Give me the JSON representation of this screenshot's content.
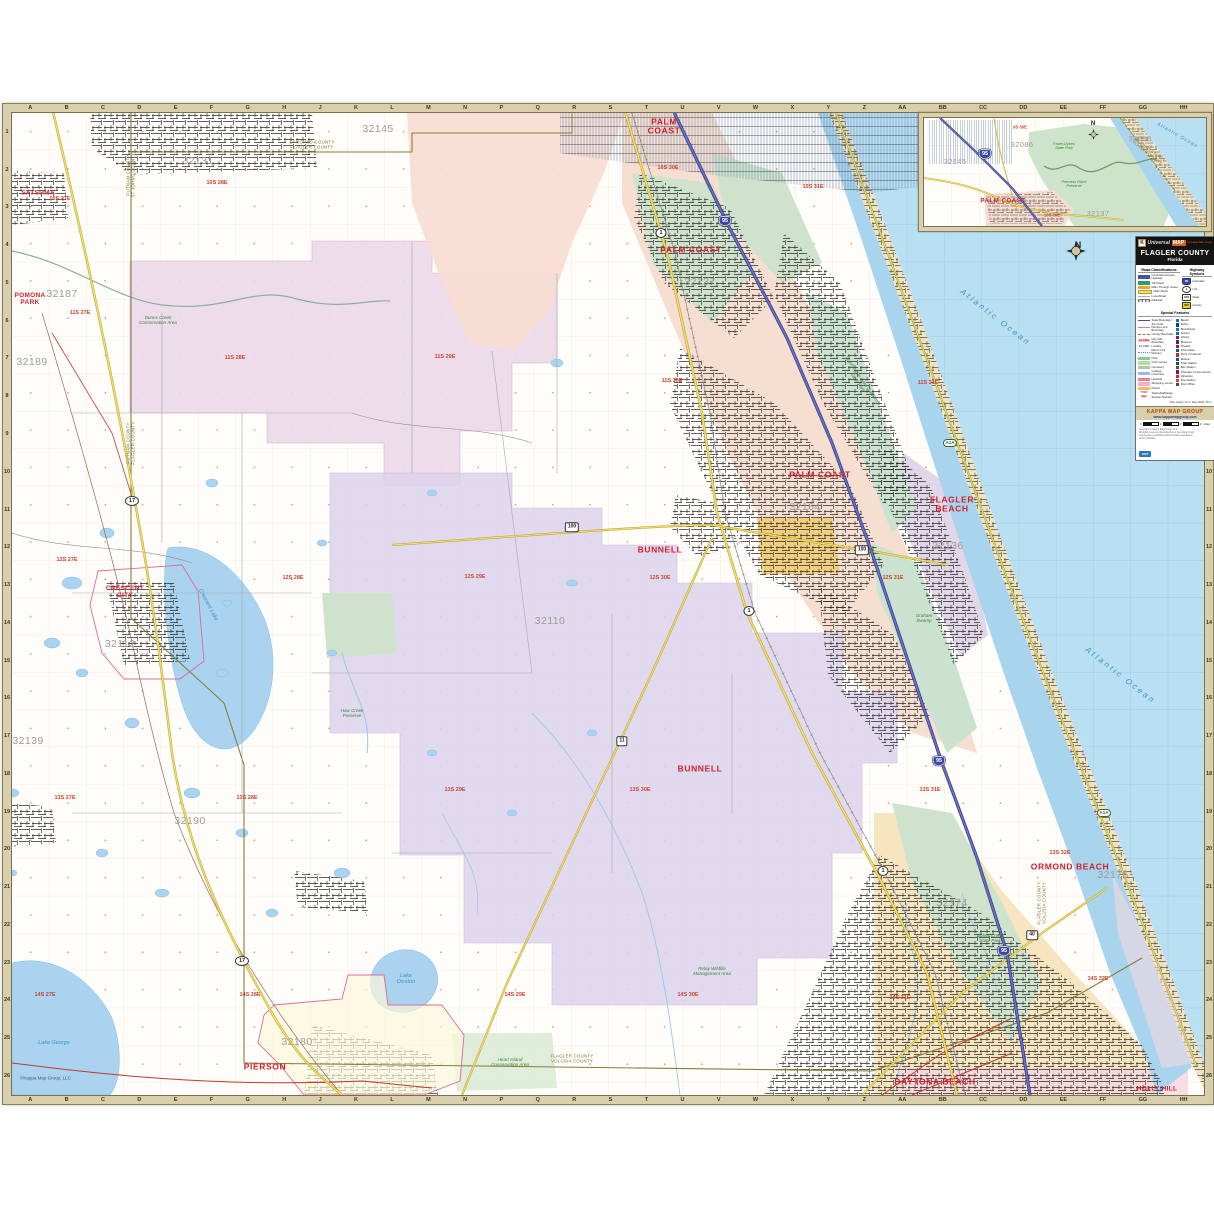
{
  "compass": {
    "n": "N"
  },
  "map": {
    "copyright": "©Kappa Map Group, LLC",
    "grid_letters": [
      "A",
      "B",
      "C",
      "D",
      "E",
      "F",
      "G",
      "H",
      "J",
      "K",
      "L",
      "M",
      "N",
      "P",
      "Q",
      "R",
      "S",
      "T",
      "U",
      "V",
      "W",
      "X",
      "Y",
      "Z",
      "AA",
      "BB",
      "CC",
      "DD",
      "EE",
      "FF",
      "GG",
      "HH"
    ],
    "grid_numbers": [
      "1",
      "2",
      "3",
      "4",
      "5",
      "6",
      "7",
      "8",
      "9",
      "10",
      "11",
      "12",
      "13",
      "14",
      "15",
      "16",
      "17",
      "18",
      "19",
      "20",
      "21",
      "22",
      "23",
      "24",
      "25",
      "26"
    ],
    "labels": [
      {
        "t": "PALM\nCOAST",
        "x": 652,
        "y": 14,
        "cls": "city",
        "n": "city-label-palm-coast-north"
      },
      {
        "t": "PALM COAST",
        "x": 679,
        "y": 137,
        "cls": "city",
        "n": "city-label-palm-coast"
      },
      {
        "t": "PALM COAST",
        "x": 808,
        "y": 362,
        "cls": "city",
        "n": "city-label-palm-coast-south"
      },
      {
        "t": "BUNNELL",
        "x": 648,
        "y": 437,
        "cls": "city",
        "n": "city-label-bunnell"
      },
      {
        "t": "BUNNELL",
        "x": 688,
        "y": 656,
        "cls": "city",
        "n": "city-label-bunnell-south"
      },
      {
        "t": "FLAGLER\nBEACH",
        "x": 940,
        "y": 392,
        "cls": "city",
        "n": "city-label-flagler-beach"
      },
      {
        "t": "ORMOND BEACH",
        "x": 1058,
        "y": 754,
        "cls": "city",
        "n": "city-label-ormond-beach"
      },
      {
        "t": "DAYTONA BEACH",
        "x": 923,
        "y": 969,
        "cls": "city",
        "n": "city-label-daytona-beach"
      },
      {
        "t": "PIERSON",
        "x": 253,
        "y": 954,
        "cls": "city",
        "n": "city-label-pierson"
      },
      {
        "t": "CRESCENT\nCITY",
        "x": 113,
        "y": 479,
        "cls": "city sm",
        "n": "city-label-crescent-city"
      },
      {
        "t": "HOLLY HILL",
        "x": 1145,
        "y": 976,
        "cls": "city sm",
        "n": "city-label-holly-hill"
      },
      {
        "t": "SATSUMA",
        "x": 26,
        "y": 80,
        "cls": "city sm",
        "n": "city-label-satsuma"
      },
      {
        "t": "POMONA\nPARK",
        "x": 18,
        "y": 186,
        "cls": "city sm",
        "n": "city-label-pomona-park"
      },
      {
        "t": "32131",
        "x": 186,
        "y": 49,
        "cls": "zip",
        "n": "zip-label"
      },
      {
        "t": "32145",
        "x": 366,
        "y": 17,
        "cls": "zip",
        "n": "zip-label"
      },
      {
        "t": "32187",
        "x": 50,
        "y": 182,
        "cls": "zip",
        "n": "zip-label"
      },
      {
        "t": "32189",
        "x": 20,
        "y": 250,
        "cls": "zip",
        "n": "zip-label"
      },
      {
        "t": "32112",
        "x": 108,
        "y": 532,
        "cls": "zip",
        "n": "zip-label"
      },
      {
        "t": "32139",
        "x": 16,
        "y": 629,
        "cls": "zip",
        "n": "zip-label"
      },
      {
        "t": "32190",
        "x": 178,
        "y": 709,
        "cls": "zip",
        "n": "zip-label"
      },
      {
        "t": "32180",
        "x": 285,
        "y": 930,
        "cls": "zip",
        "n": "zip-label"
      },
      {
        "t": "32110",
        "x": 538,
        "y": 509,
        "cls": "zip",
        "n": "zip-label"
      },
      {
        "t": "32164",
        "x": 793,
        "y": 395,
        "cls": "zip",
        "n": "zip-label"
      },
      {
        "t": "32136",
        "x": 936,
        "y": 434,
        "cls": "zip",
        "n": "zip-label"
      },
      {
        "t": "32137",
        "x": 688,
        "y": 170,
        "cls": "zip",
        "n": "zip-label"
      },
      {
        "t": "32174",
        "x": 940,
        "y": 791,
        "cls": "zip",
        "n": "zip-label"
      },
      {
        "t": "32176",
        "x": 1101,
        "y": 763,
        "cls": "zip",
        "n": "zip-label"
      },
      {
        "t": "10S 27E",
        "x": 48,
        "y": 86,
        "cls": "twn",
        "n": "township-label"
      },
      {
        "t": "10S 28E",
        "x": 205,
        "y": 70,
        "cls": "twn",
        "n": "township-label"
      },
      {
        "t": "10S 30E",
        "x": 656,
        "y": 55,
        "cls": "twn",
        "n": "township-label"
      },
      {
        "t": "10S 31E",
        "x": 801,
        "y": 74,
        "cls": "twn",
        "n": "township-label"
      },
      {
        "t": "11S 27E",
        "x": 68,
        "y": 200,
        "cls": "twn",
        "n": "township-label"
      },
      {
        "t": "11S 28E",
        "x": 223,
        "y": 245,
        "cls": "twn",
        "n": "township-label"
      },
      {
        "t": "11S 29E",
        "x": 433,
        "y": 244,
        "cls": "twn",
        "n": "township-label"
      },
      {
        "t": "11S 30E",
        "x": 660,
        "y": 268,
        "cls": "twn",
        "n": "township-label"
      },
      {
        "t": "11S 31E",
        "x": 916,
        "y": 270,
        "cls": "twn",
        "n": "township-label"
      },
      {
        "t": "12S 27E",
        "x": 55,
        "y": 447,
        "cls": "twn",
        "n": "township-label"
      },
      {
        "t": "12S 28E",
        "x": 281,
        "y": 465,
        "cls": "twn",
        "n": "township-label"
      },
      {
        "t": "12S 29E",
        "x": 463,
        "y": 464,
        "cls": "twn",
        "n": "township-label"
      },
      {
        "t": "12S 30E",
        "x": 648,
        "y": 465,
        "cls": "twn",
        "n": "township-label"
      },
      {
        "t": "12S 31E",
        "x": 881,
        "y": 465,
        "cls": "twn",
        "n": "township-label"
      },
      {
        "t": "13S 27E",
        "x": 53,
        "y": 685,
        "cls": "twn",
        "n": "township-label"
      },
      {
        "t": "13S 28E",
        "x": 235,
        "y": 685,
        "cls": "twn",
        "n": "township-label"
      },
      {
        "t": "13S 29E",
        "x": 443,
        "y": 677,
        "cls": "twn",
        "n": "township-label"
      },
      {
        "t": "13S 30E",
        "x": 628,
        "y": 677,
        "cls": "twn",
        "n": "township-label"
      },
      {
        "t": "13S 31E",
        "x": 918,
        "y": 677,
        "cls": "twn",
        "n": "township-label"
      },
      {
        "t": "13S 32E",
        "x": 1048,
        "y": 740,
        "cls": "twn",
        "n": "township-label"
      },
      {
        "t": "14S 27E",
        "x": 33,
        "y": 882,
        "cls": "twn",
        "n": "township-label"
      },
      {
        "t": "14S 28E",
        "x": 238,
        "y": 882,
        "cls": "twn",
        "n": "township-label"
      },
      {
        "t": "14S 29E",
        "x": 503,
        "y": 882,
        "cls": "twn",
        "n": "township-label"
      },
      {
        "t": "14S 30E",
        "x": 676,
        "y": 882,
        "cls": "twn",
        "n": "township-label"
      },
      {
        "t": "14S 31E",
        "x": 888,
        "y": 885,
        "cls": "twn",
        "n": "township-label"
      },
      {
        "t": "14S 32E",
        "x": 1086,
        "y": 866,
        "cls": "twn",
        "n": "township-label"
      },
      {
        "t": "Crescent Lake",
        "x": 196,
        "y": 492,
        "rot": 62,
        "cls": "water",
        "n": "water-label-crescent-lake"
      },
      {
        "t": "Lake\nDisston",
        "x": 394,
        "y": 866,
        "cls": "water",
        "n": "water-label-lake-disston"
      },
      {
        "t": "Lake George",
        "x": 42,
        "y": 930,
        "cls": "water",
        "n": "water-label-lake-george"
      },
      {
        "t": "Atlantic  Ocean",
        "x": 983,
        "y": 205,
        "rot": 38,
        "cls": "water ocean",
        "n": "water-label-atlantic-ocean"
      },
      {
        "t": "Atlantic  Ocean",
        "x": 1108,
        "y": 563,
        "rot": 38,
        "cls": "water ocean",
        "n": "water-label-atlantic-ocean"
      },
      {
        "t": "Dunns Creek\nConservation Area",
        "x": 146,
        "y": 207,
        "cls": "park",
        "n": "park-label"
      },
      {
        "t": "Haw Creek\nPreserve",
        "x": 340,
        "y": 600,
        "cls": "park",
        "n": "park-label"
      },
      {
        "t": "Relay Wildlife\nManagement Area",
        "x": 700,
        "y": 858,
        "cls": "park",
        "n": "park-label"
      },
      {
        "t": "Bulow Creek\nState Park",
        "x": 978,
        "y": 825,
        "cls": "park",
        "n": "park-label"
      },
      {
        "t": "Washington Oaks Gardens\nState Park",
        "x": 848,
        "y": 268,
        "rot": 55,
        "cls": "park",
        "n": "park-label"
      },
      {
        "t": "Graham\nSwamp",
        "x": 912,
        "y": 505,
        "cls": "park",
        "n": "park-label"
      },
      {
        "t": "Heart Island\nConservation Area",
        "x": 498,
        "y": 949,
        "cls": "park",
        "n": "park-label"
      },
      {
        "t": "PUTNAM COUNTY\nST JOHNS COUNTY",
        "x": 119,
        "y": 62,
        "rot": -90,
        "cls": "cnty",
        "n": "county-boundary-label"
      },
      {
        "t": "PUTNAM COUNTY\nFLAGLER COUNTY",
        "x": 119,
        "y": 330,
        "rot": -90,
        "cls": "cnty",
        "n": "county-boundary-label"
      },
      {
        "t": "ST JOHNS COUNTY\nFLAGLER COUNTY",
        "x": 300,
        "y": 32,
        "cls": "cnty",
        "n": "county-boundary-label"
      },
      {
        "t": "FLAGLER COUNTY\nVOLUSIA COUNTY",
        "x": 1030,
        "y": 790,
        "rot": -90,
        "cls": "cnty",
        "n": "county-boundary-label"
      },
      {
        "t": "FLAGLER COUNTY\nVOLUSIA COUNTY",
        "x": 560,
        "y": 946,
        "cls": "cnty",
        "n": "county-boundary-label"
      },
      {
        "t": "95",
        "x": 713,
        "y": 108,
        "cls": "sh shi",
        "n": "interstate-95-shield"
      },
      {
        "t": "95",
        "x": 927,
        "y": 648,
        "cls": "sh shi",
        "n": "interstate-95-shield"
      },
      {
        "t": "95",
        "x": 992,
        "y": 838,
        "cls": "sh shi",
        "n": "interstate-95-shield"
      },
      {
        "t": "1",
        "x": 649,
        "y": 120,
        "cls": "sh shus",
        "n": "us-1-shield"
      },
      {
        "t": "1",
        "x": 737,
        "y": 498,
        "cls": "sh shus",
        "n": "us-1-shield"
      },
      {
        "t": "1",
        "x": 871,
        "y": 758,
        "cls": "sh shus",
        "n": "us-1-shield"
      },
      {
        "t": "17",
        "x": 120,
        "y": 388,
        "cls": "sh shus",
        "n": "us-17-shield"
      },
      {
        "t": "17",
        "x": 230,
        "y": 848,
        "cls": "sh shus",
        "n": "us-17-shield"
      },
      {
        "t": "100",
        "x": 560,
        "y": 414,
        "cls": "sh shst",
        "n": "sr-100-shield"
      },
      {
        "t": "100",
        "x": 850,
        "y": 437,
        "cls": "sh shst",
        "n": "sr-100-shield"
      },
      {
        "t": "11",
        "x": 610,
        "y": 628,
        "cls": "sh shst",
        "n": "sr-11-shield"
      },
      {
        "t": "40",
        "x": 1020,
        "y": 822,
        "cls": "sh shst",
        "n": "sr-40-shield"
      },
      {
        "t": "A1A",
        "x": 938,
        "y": 330,
        "cls": "sh sha",
        "n": "a1a-shield"
      },
      {
        "t": "A1A",
        "x": 1092,
        "y": 700,
        "cls": "sh sha",
        "n": "a1a-shield"
      },
      {
        "t": "©Kappa Map Group, LLC",
        "x": 8,
        "y": 966,
        "cls": "mapcp",
        "n": "map-copyright"
      }
    ]
  },
  "inset": {
    "labels": [
      {
        "t": "PALM COAST",
        "x": 79,
        "y": 84,
        "cls": "city",
        "n": "inset-city-label-palm-coast"
      },
      {
        "t": "32145",
        "x": 31,
        "y": 44,
        "cls": "zip",
        "n": "inset-zip-label"
      },
      {
        "t": "32086",
        "x": 98,
        "y": 27,
        "cls": "zip",
        "n": "inset-zip-label"
      },
      {
        "t": "32137",
        "x": 174,
        "y": 96,
        "cls": "zip",
        "n": "inset-zip-label"
      },
      {
        "t": "32080",
        "x": 216,
        "y": 21,
        "cls": "zip",
        "n": "inset-zip-label"
      },
      {
        "t": "9S 30E",
        "x": 96,
        "y": 10,
        "cls": "twn",
        "n": "inset-township-label"
      },
      {
        "t": "10S 30E",
        "x": 128,
        "y": 98,
        "cls": "twn",
        "n": "inset-township-label"
      },
      {
        "t": "Atlantic\nOcean",
        "x": 253,
        "y": 18,
        "rot": 30,
        "cls": "water ocean",
        "n": "inset-water-label-atlantic-ocean"
      },
      {
        "t": "Faver-Dykes\nState Park",
        "x": 140,
        "y": 28,
        "cls": "park",
        "n": "inset-park-label"
      },
      {
        "t": "Princess Place\nPreserve",
        "x": 150,
        "y": 66,
        "cls": "park",
        "n": "inset-park-label"
      },
      {
        "t": "ST JOHNS COUNTY\nFLAGLER COUNTY",
        "x": 224,
        "y": 34,
        "rot": 38,
        "cls": "cnty",
        "n": "inset-county-boundary-label"
      },
      {
        "t": "95",
        "x": 61,
        "y": 36,
        "cls": "sh shi",
        "n": "inset-interstate-95-shield"
      }
    ]
  },
  "legend": {
    "brand": {
      "k": "K",
      "universal": "Universal",
      "map": "MAP",
      "tagline": "by Kappa Map Group"
    },
    "title": "FLAGLER COUNTY",
    "subtitle": "Florida",
    "road_class": {
      "heading": "Road Classifications",
      "items": [
        {
          "label": "Controlled Access Highway",
          "style": "cah"
        },
        {
          "label": "Toll Road",
          "style": "toll"
        },
        {
          "label": "Main Through Street",
          "style": "mts"
        },
        {
          "label": "Main Road",
          "style": "mr"
        },
        {
          "label": "Local Road",
          "style": "lr"
        },
        {
          "label": "Railroad",
          "style": "rr"
        }
      ]
    },
    "hwy": {
      "heading": "Highway Symbols",
      "items": [
        {
          "label": "Interstate",
          "shape": "i",
          "num": "95"
        },
        {
          "label": "U.S.",
          "shape": "u",
          "num": "1"
        },
        {
          "label": "State",
          "shape": "s",
          "num": "100"
        },
        {
          "label": "County",
          "shape": "c",
          "num": "305"
        }
      ]
    },
    "special": {
      "heading": "Special Features",
      "left": [
        {
          "label": "State Boundary",
          "sw": "b-state"
        },
        {
          "label": "Zip Code Number and Boundary",
          "sw": "b-zip"
        },
        {
          "label": "County Boundary",
          "sw": "b-cnty"
        },
        {
          "label": "City and Boundary",
          "sw": "b-city",
          "sample": "CLARK"
        },
        {
          "label": "Locality",
          "sw": "b-loc",
          "sample": "CLARK"
        },
        {
          "label": "Minor Civil Division",
          "sw": "b-mcd"
        },
        {
          "label": "Park",
          "sw": "f-park"
        },
        {
          "label": "Golf Course",
          "sw": "f-golf"
        },
        {
          "label": "Cemetery",
          "sw": "f-cem"
        },
        {
          "label": "College, University",
          "sw": "f-col"
        },
        {
          "label": "Hospital",
          "sw": "f-hosp"
        },
        {
          "label": "Shopping Center",
          "sw": "f-shop"
        },
        {
          "label": "Resort",
          "sw": "f-res"
        },
        {
          "label": "Township/Range",
          "sw": "t-twn",
          "sample": "TWN RGE"
        },
        {
          "label": "Section Number",
          "sw": "t-sec",
          "sample": "6"
        }
      ],
      "right": [
        {
          "label": "Beach",
          "c": "#00838f"
        },
        {
          "label": "Police",
          "c": "#283593"
        },
        {
          "label": "Boat Ramp",
          "c": "#0277bd"
        },
        {
          "label": "School",
          "c": "#1565c0"
        },
        {
          "label": "Library",
          "c": "#6a1b9a"
        },
        {
          "label": "Museum",
          "c": "#4e342e"
        },
        {
          "label": "Theater",
          "c": "#ad1457"
        },
        {
          "label": "Information",
          "c": "#00695c"
        },
        {
          "label": "Point of Interest",
          "c": "#c62828"
        },
        {
          "label": "Marina",
          "c": "#01579b"
        },
        {
          "label": "Train Station",
          "c": "#37474f"
        },
        {
          "label": "Bus Station",
          "c": "#455a64"
        },
        {
          "label": "Chamber of Commerce",
          "c": "#880e4f"
        },
        {
          "label": "Attraction",
          "c": "#d81b60"
        },
        {
          "label": "Fire Station",
          "c": "#e53935"
        },
        {
          "label": "Post Office",
          "c": "#5d4037"
        }
      ]
    },
    "size_note": "Map Height: 40 in.  Map Width: 48 in.",
    "banner": {
      "brand": "KAPPA MAP GROUP",
      "url": "www.kappamapgroup.com"
    },
    "scale": {
      "ticks": [
        "0",
        "1",
        "2",
        "3"
      ],
      "unit": "miles"
    },
    "copyright_lines": [
      "Copyright © Kappa Map Group, LLC",
      "All rights reserved. Reproduction or recording of any",
      "map herein is prohibited without written permission",
      "of the publisher."
    ],
    "chip": "GDT"
  }
}
